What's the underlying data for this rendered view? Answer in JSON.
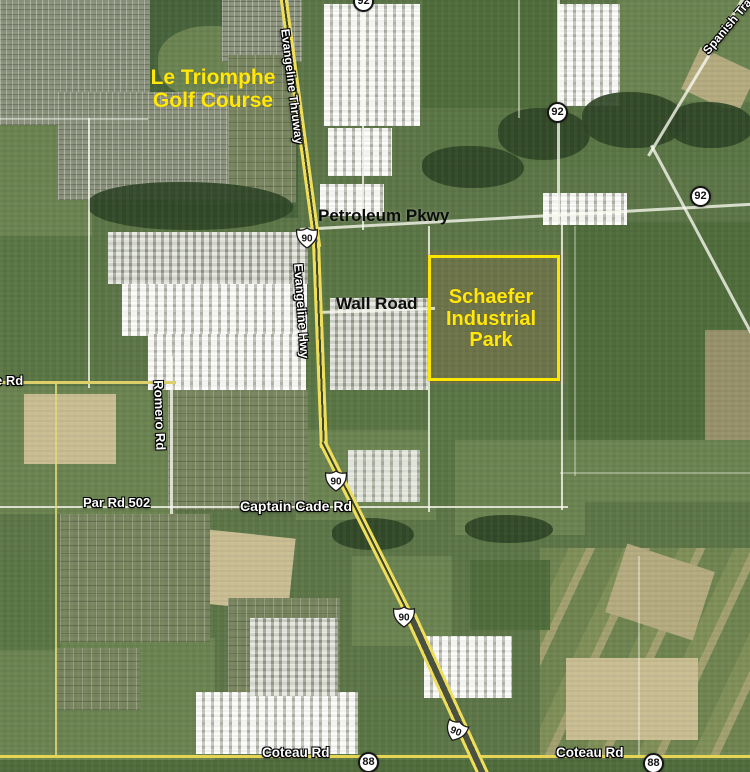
{
  "map_labels": {
    "golf_course": "Le Triomphe\nGolf Course",
    "petroleum_pkwy": "Petroleum Pkwy",
    "wall_road": "Wall Road",
    "schaefer_park": "Schaefer\nIndustrial\nPark",
    "evangeline_thruway": "Evangeline Thruway",
    "evangeline_hwy": "Evangeline Hwy",
    "romero_rd": "Romero Rd",
    "par_rd_502": "Par Rd 502",
    "captain_cade_rd": "Captain Cade Rd",
    "coteau_rd_west": "Coteau Rd",
    "coteau_rd_east": "Coteau Rd",
    "left_edge_rd_fragment": "e Rd",
    "spanish_trail_fragment": "Spanish Trail"
  },
  "route_shields": {
    "us_90": "90",
    "la_92": "92",
    "la_88": "88"
  },
  "annotation_colors": {
    "highlight_yellow": "#ffe80a",
    "park_outline": "#fae600",
    "road_label_white": "#ffffff",
    "street_label_black": "#0d0d0d"
  }
}
